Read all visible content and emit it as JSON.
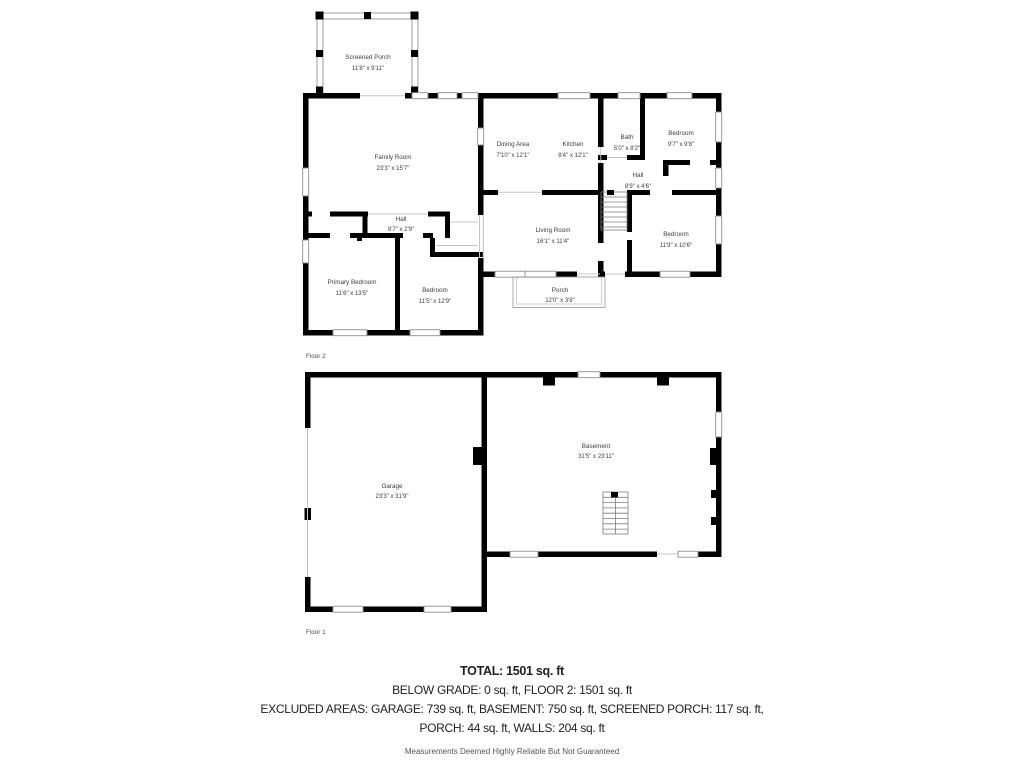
{
  "floor2": {
    "label": "Floor 2",
    "rooms": {
      "screened_porch": {
        "name": "Screened Porch",
        "dims": "11'8\" x 9'11\""
      },
      "family_room": {
        "name": "Family Room",
        "dims": "23'3\" x 15'7\""
      },
      "dining_area": {
        "name": "Dining Area",
        "dims": "7'10\" x 12'1\""
      },
      "kitchen": {
        "name": "Kitchen",
        "dims": "8'4\" x 12'1\""
      },
      "bath": {
        "name": "Bath",
        "dims": "5'0\" x 8'2\""
      },
      "bedroom_top_right": {
        "name": "Bedroom",
        "dims": "9'7\" x 9'8\""
      },
      "hall_right": {
        "name": "Hall",
        "dims": "8'9\" x 4'6\""
      },
      "living_room": {
        "name": "Living Room",
        "dims": "16'1\" x 11'4\""
      },
      "bedroom_bottom_right": {
        "name": "Bedroom",
        "dims": "11'9\" x 10'6\""
      },
      "hall_left": {
        "name": "Hall",
        "dims": "8'7\" x 2'9\""
      },
      "primary_bedroom": {
        "name": "Primary Bedroom",
        "dims": "11'6\" x 13'5\""
      },
      "bedroom_bottom_left": {
        "name": "Bedroom",
        "dims": "11'5\" x 12'9\""
      },
      "porch": {
        "name": "Porch",
        "dims": "12'0\" x 3'8\""
      }
    }
  },
  "floor1": {
    "label": "Floor 1",
    "rooms": {
      "garage": {
        "name": "Garage",
        "dims": "23'3\" x 31'9\""
      },
      "basement": {
        "name": "Basement",
        "dims": "31'5\" x 23'11\""
      }
    }
  },
  "summary": {
    "total": "TOTAL: 1501 sq. ft",
    "line2": "BELOW GRADE: 0 sq. ft, FLOOR 2: 1501 sq. ft",
    "line3": "EXCLUDED AREAS: GARAGE: 739 sq. ft, BASEMENT: 750 sq. ft, SCREENED PORCH: 117 sq. ft,",
    "line4": "PORCH: 44 sq. ft, WALLS: 204 sq. ft",
    "disclaimer": "Measurements Deemed Highly Reliable But Not Guaranteed"
  },
  "colors": {
    "wall": "#000000",
    "window_frame": "#8f8f8f",
    "label_text": "#3c3c3c"
  }
}
